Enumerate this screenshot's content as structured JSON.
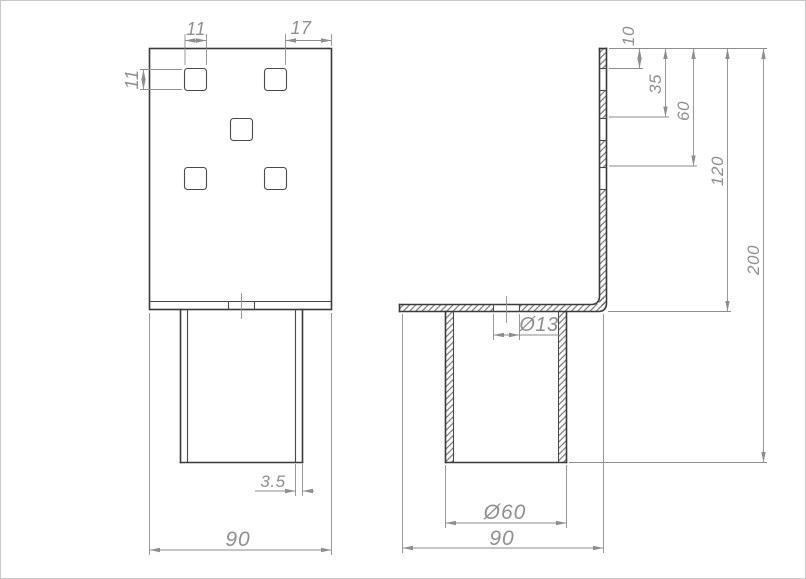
{
  "drawing": {
    "kind": "technical-drawing-two-views",
    "views": {
      "front_label": "front-view",
      "side_label": "side-section-view"
    },
    "dimensions": {
      "front": {
        "hole_width": "11",
        "hole_offset_right": "17",
        "hole_height": "11",
        "wall_thickness": "3.5",
        "plate_width": "90"
      },
      "side": {
        "hole_row1_offset": "10",
        "hole_row2_offset": "35",
        "hole_row3_offset": "60",
        "flange_offset": "120",
        "overall_height": "200",
        "flange_hole_diameter": "Ø13",
        "tube_diameter": "Ø60",
        "base_width": "90"
      }
    },
    "colors": {
      "background": "#ffffff",
      "outline": "#3a3a3a",
      "dimension_lines": "#8e8e8e",
      "text": "#8f8f8f",
      "hatch": "#606060"
    }
  }
}
